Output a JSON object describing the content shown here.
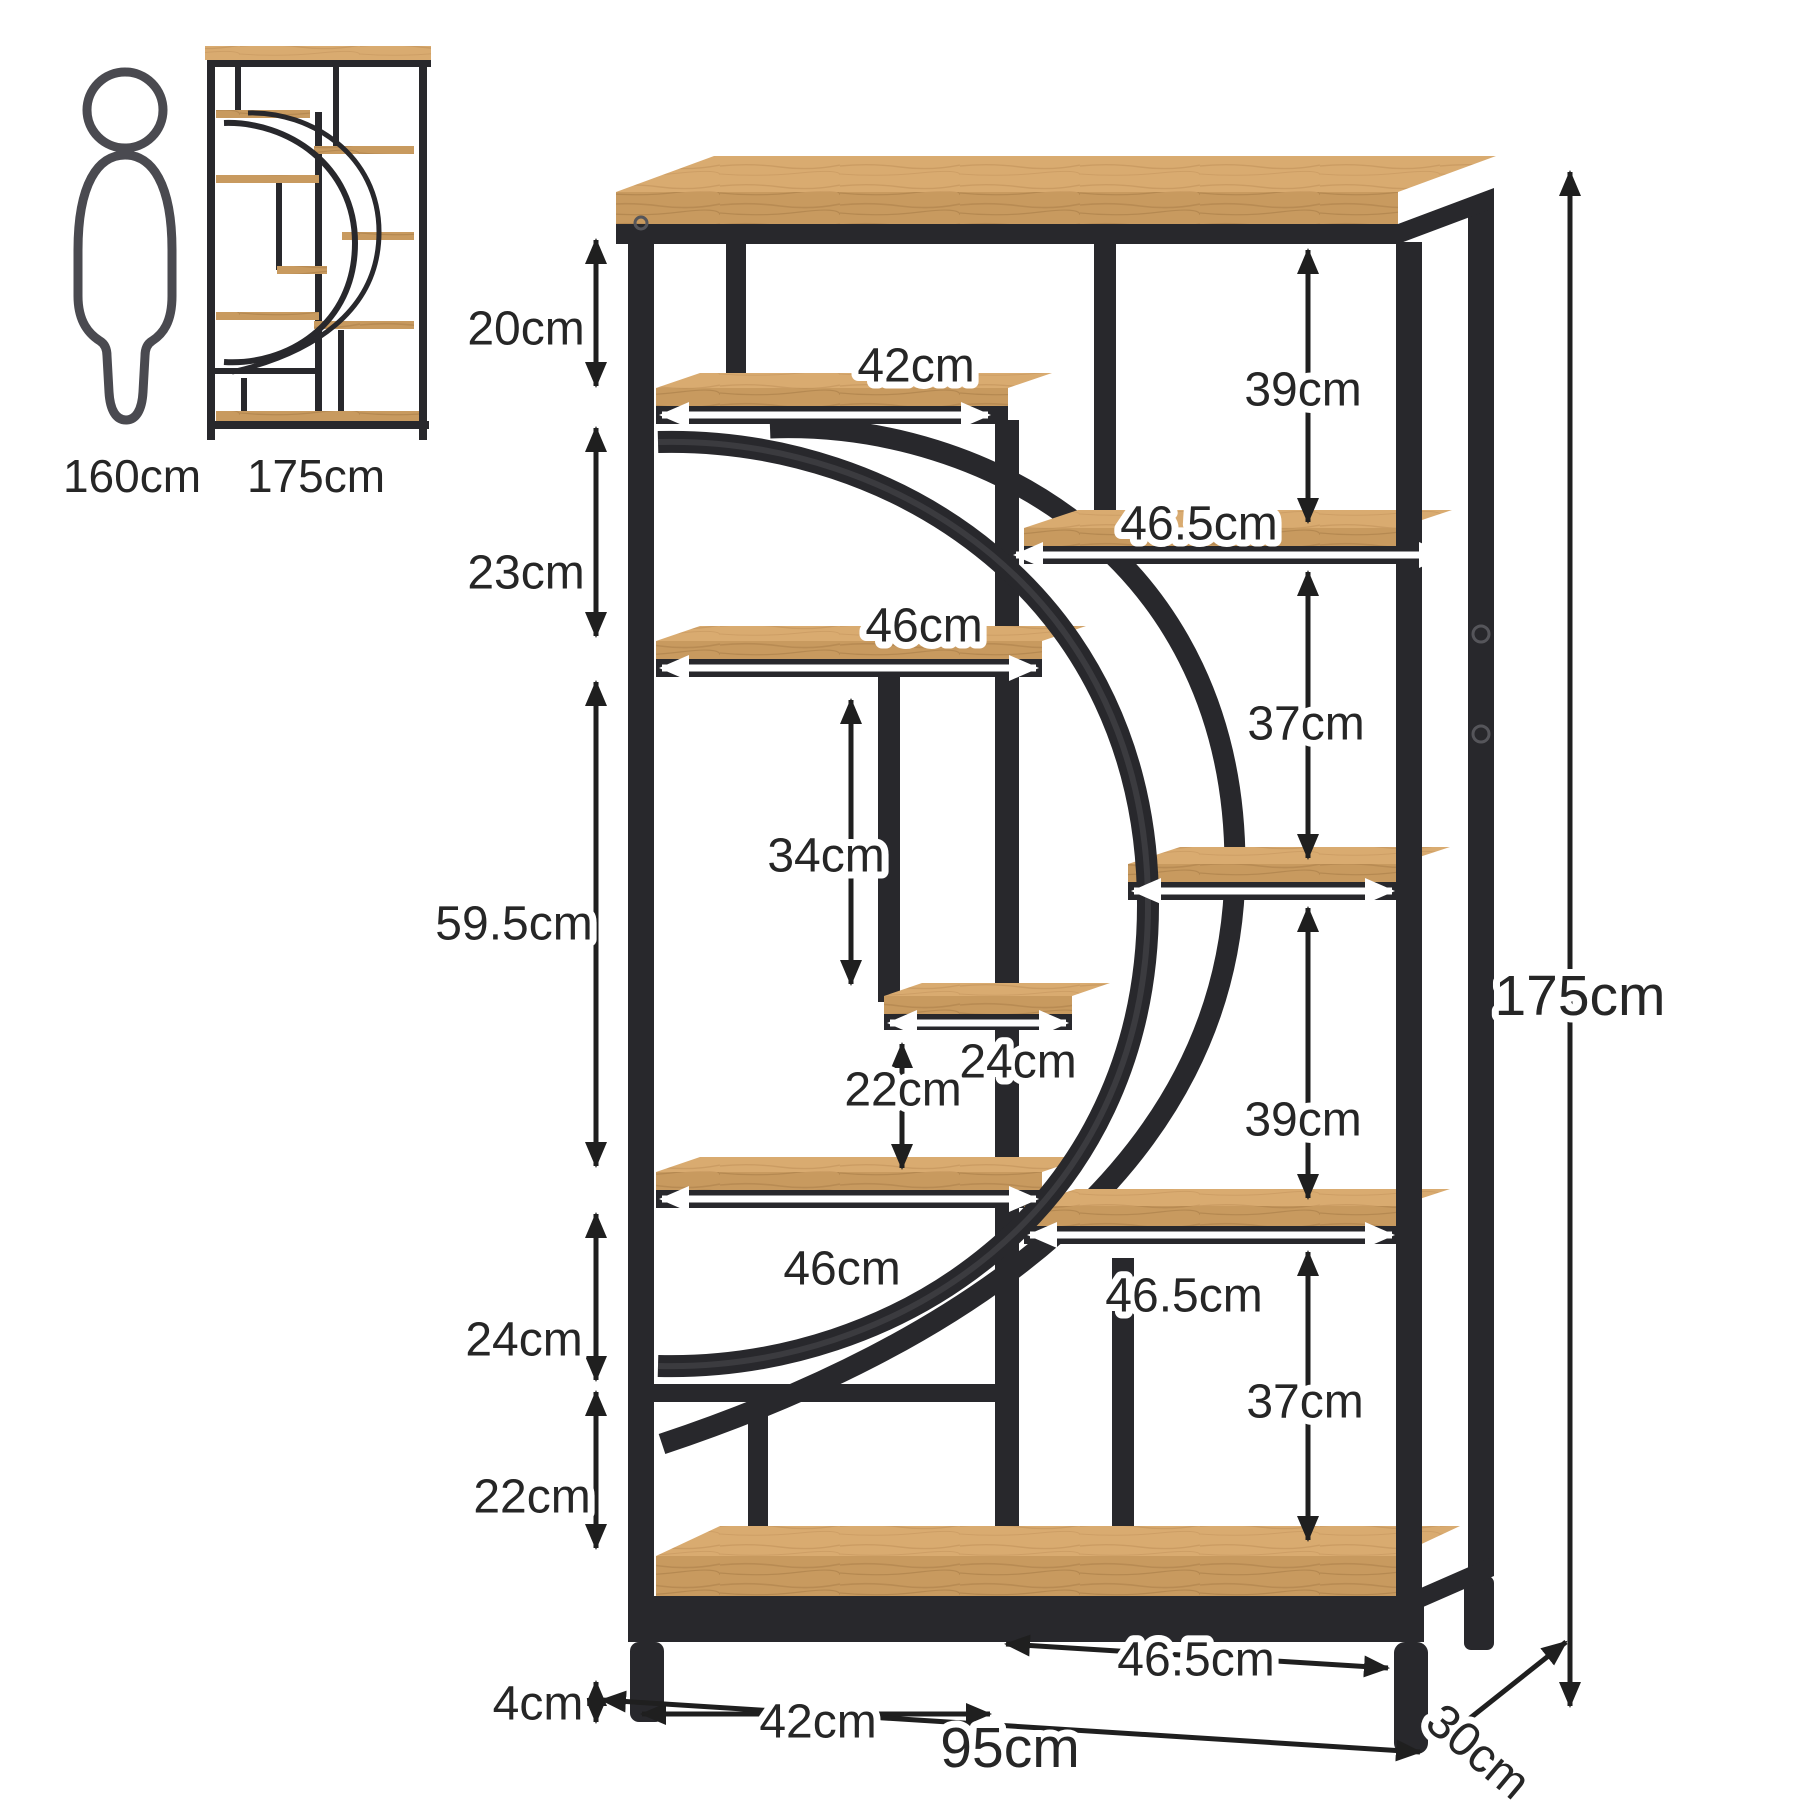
{
  "diagram_type": "furniture-dimension-diagram",
  "product": "industrial arc bookshelf with 8 open shelves",
  "colors": {
    "wood": "#c89a5f",
    "wood_light": "#d9ab70",
    "wood_line": "#b2854e",
    "metal": "#28282c",
    "metal_light": "#4a4a50",
    "arrow": "#1f1f1f",
    "label": "#262626",
    "bg": "#ffffff"
  },
  "reference": {
    "person_height": "160cm",
    "thumbnail_height": "175cm"
  },
  "labels": {
    "gap_top": "20cm",
    "gap_2": "23cm",
    "gap_3": "59.5cm",
    "gap_4": "24cm",
    "gap_5": "22cm",
    "feet": "4cm",
    "shelf_a": "42cm",
    "shelf_b": "46cm",
    "shelf_small": "24cm",
    "shelf_c": "46cm",
    "v_34": "34cm",
    "v_22": "22cm",
    "r_39a": "39cm",
    "r_465a": "46.5cm",
    "r_37a": "37cm",
    "r_39b": "39cm",
    "r_465b": "46.5cm",
    "r_37b": "37cm",
    "bay_left": "42cm",
    "bay_right": "46.5cm",
    "width_total": "95cm",
    "depth": "30cm",
    "height_total": "175cm"
  }
}
